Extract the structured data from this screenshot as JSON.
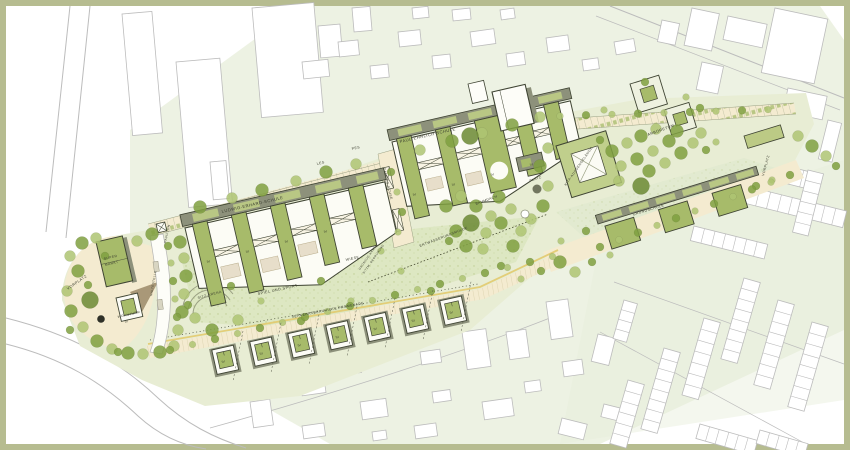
{
  "labels": {
    "les_full": "LUDWIG-ERHARD-SCHULE",
    "pes_full": "PAUL-EHRLICH-SCHULE",
    "les": "LES",
    "pes": "PES",
    "grundschule": "GRUNDSCHULE",
    "kita": "KITA-AUSSENGELÄNDE",
    "arboretum": "ARBORETUM",
    "baumdach": "BAUMDACH",
    "platz": "PLATZ",
    "wiese": "WIESE",
    "spiel_sport": "SPIEL UND SPORT",
    "sitz_arena": "SITZ-ARENA",
    "entwaesserung": "ENTWÄSSERUNGSMULDE",
    "campus_achse": "CAMPUS-ACHSE",
    "promenade": "VERKEHRSBERUHIGTE PROMENADE",
    "gruenzug_1": "GRÜNZUG-KANTE",
    "gruenzug_2": "SITZM. BEGRÜNUNG",
    "vorplatz_west": "VORPLATZ",
    "vorplatz_ost": "VORPLATZ",
    "supermarkt_1": "SUPER",
    "supermarkt_2": "MARKT",
    "wohnturm": "WOHNTURM",
    "pavillon": "PAVILLON",
    "haltestelle": "HALTESTELLE",
    "floors": {
      "f1": "IV",
      "f2": "III",
      "f3": "IV",
      "f4": "IV",
      "f5": "IV",
      "f6": "III",
      "f7": "IV",
      "f8": "III",
      "h1": "IV",
      "h2": "III",
      "h3": "IV",
      "h4": "III",
      "h5": "IV",
      "h6": "III",
      "h7": "IV",
      "wohnturm_f": "IV"
    }
  },
  "colors": {
    "frame": "#b6bc90",
    "wash": "#e7eed9",
    "lawn": "#e8edd4",
    "meadow": "#dde7c2",
    "cream": "#f4ebd0",
    "roof": "#a7bb6a",
    "roof_light": "#bcca85",
    "olive": "#8d917b",
    "outline": "#3f4433",
    "tree_dark": "#80a040",
    "tree_light": "#afc573",
    "ctx_line": "#bcbcbc",
    "yellow": "#e2ca6e",
    "ink": "#3a3d2f",
    "shadow_brown": "#9b8a68"
  }
}
